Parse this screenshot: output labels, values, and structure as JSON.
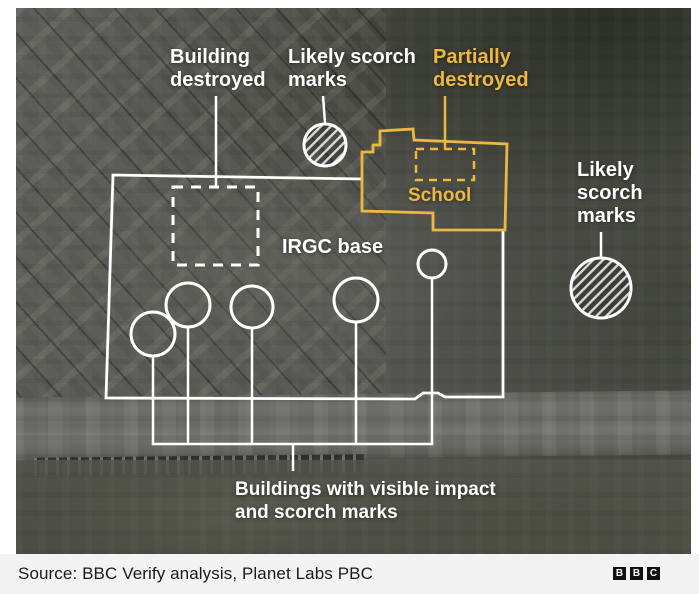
{
  "annotations": {
    "building_destroyed": {
      "lines": [
        "Building",
        "destroyed"
      ]
    },
    "scorch_top": {
      "lines": [
        "Likely scorch",
        "marks"
      ]
    },
    "partially_destroyed": {
      "lines": [
        "Partially",
        "destroyed"
      ]
    },
    "school": {
      "label": "School"
    },
    "irgc_base": {
      "label": "IRGC base"
    },
    "scorch_right": {
      "lines": [
        "Likely",
        "scorch",
        "marks"
      ]
    },
    "impact_label": {
      "lines": [
        "Buildings with visible impact",
        "and scorch marks"
      ]
    }
  },
  "source": {
    "text": "Source: BBC Verify analysis, Planet Labs PBC"
  },
  "logo": {
    "letters": [
      "B",
      "B",
      "C"
    ]
  },
  "colors": {
    "annotation_white": "#ffffff",
    "annotation_yellow": "#edb83f",
    "source_bar_bg": "#f3f3f3",
    "source_text": "#1a1a1a",
    "logo_bg": "#121212"
  }
}
